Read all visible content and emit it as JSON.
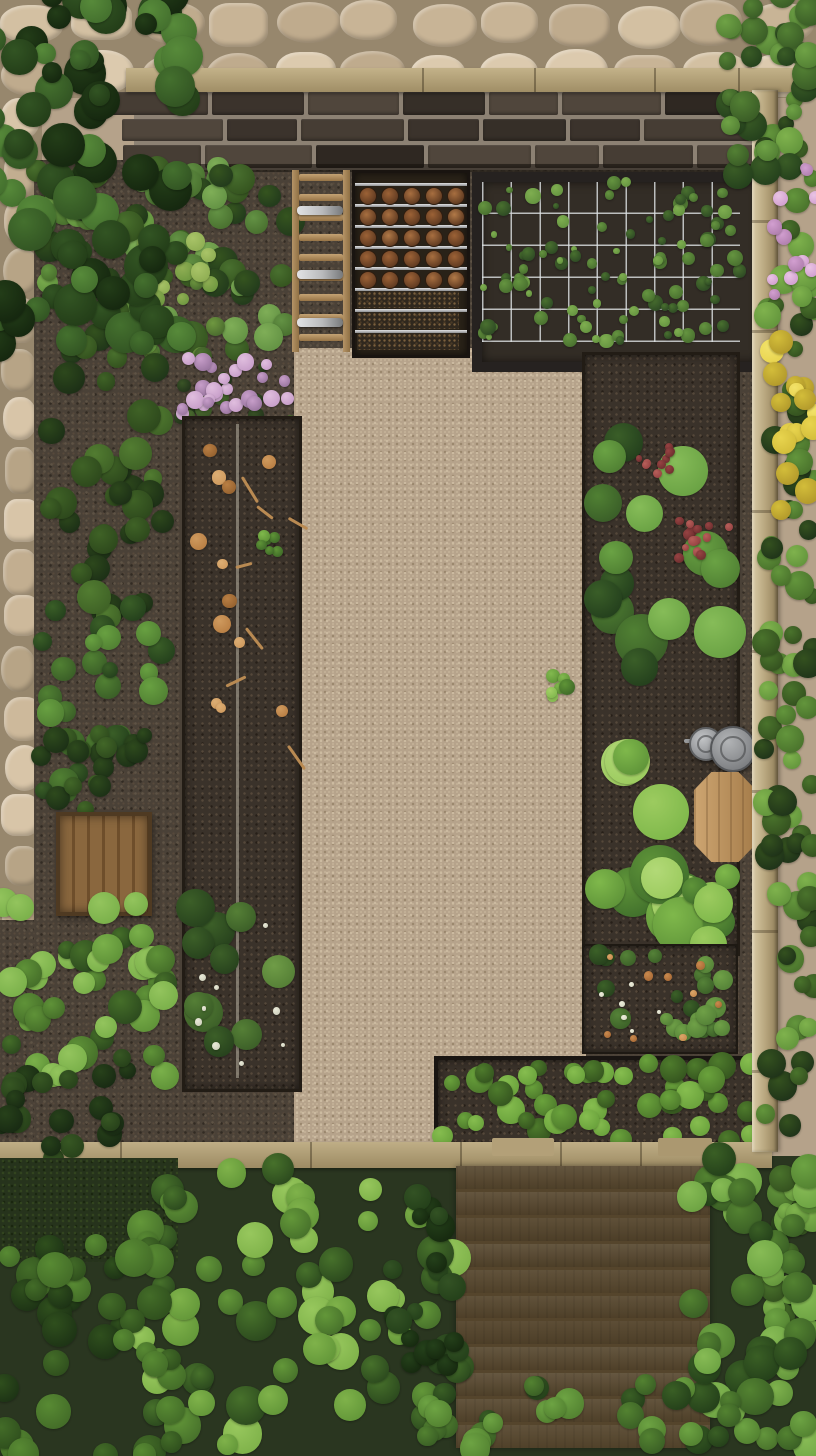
{
  "meta": {
    "title": "Aerial top-down view of a walled kitchen garden with raised beds, gravel path, stone paving, wooden deck and dense shrubs",
    "width": 816,
    "height": 1456
  },
  "palette": {
    "stone": "#d3c0a2",
    "grout": "#97876d",
    "brick": "#3b332c",
    "mortar": "#8c8173",
    "wood_rail": "#bfae86",
    "fence": "#c2b28c",
    "gravel": "#b6a38b",
    "soil": "#3a322a",
    "ground": "#4a4137",
    "leaf_dark": "#223a1c",
    "leaf_mid": "#49702f",
    "leaf_light": "#7fae57",
    "hedge": "#6aa23c",
    "pink": "#c79ec9",
    "yellow": "#e8d44e",
    "red": "#974343",
    "dry_leaf": "#b97f44",
    "deck": "#a78c63",
    "crate": "#7c5c38",
    "table": "#bf9a62",
    "bin": "#97999b",
    "wire": "#dee2e4",
    "white_flower": "#e9ead8",
    "orange_flower": "#c98a4e"
  },
  "items": [
    {
      "name": "stone-paving-top",
      "type": "cobbles",
      "x": 0,
      "y": 0,
      "w": 816,
      "h": 98,
      "cols": 12,
      "rows": 2,
      "jitter": 7,
      "seed": 3,
      "grout": "#97876d",
      "colors": [
        "#dccaae",
        "#d3c0a2",
        "#c8b496",
        "#bfab8d"
      ]
    },
    {
      "name": "stone-paving-left",
      "type": "cobbles",
      "x": 0,
      "y": 96,
      "w": 42,
      "h": 846,
      "cols": 1,
      "rows": 17,
      "jitter": 4,
      "seed": 4,
      "grout": "#97876d",
      "colors": [
        "#d8c5a8",
        "#cdb99b",
        "#c2ae90",
        "#b7a486"
      ]
    },
    {
      "name": "ground-left-under",
      "type": "rect",
      "x": 0,
      "y": 920,
      "w": 46,
      "h": 244,
      "texture": "ground"
    },
    {
      "name": "bottom-greenery-base",
      "type": "rect",
      "x": 0,
      "y": 1156,
      "w": 816,
      "h": 300,
      "fill": "#2a3620"
    },
    {
      "name": "garden-ground",
      "type": "rect",
      "x": 34,
      "y": 160,
      "w": 724,
      "h": 992,
      "texture": "ground"
    },
    {
      "name": "gravel-path",
      "type": "rect",
      "x": 294,
      "y": 348,
      "w": 292,
      "h": 800,
      "texture": "gravel"
    },
    {
      "name": "brick-wall",
      "type": "bricks",
      "x": 134,
      "y": 90,
      "w": 630,
      "h": 80,
      "rows": 3,
      "seed": 5,
      "mortar": "#8c8173",
      "colors": [
        "#3b332c",
        "#463d34",
        "#2f2822",
        "#50463c",
        "#362f28"
      ]
    },
    {
      "name": "top-wood-rail",
      "type": "wood",
      "x": 126,
      "y": 68,
      "w": 690,
      "h": 24,
      "dir": "h",
      "base": [
        "#c3b289",
        "#a08e66"
      ],
      "joints": [
        56,
        296,
        408,
        528,
        612
      ]
    },
    {
      "name": "beds-top-frame",
      "type": "rect",
      "x": 134,
      "y": 164,
      "w": 630,
      "h": 8,
      "fill": "rgba(25,20,15,0.6)"
    },
    {
      "name": "leafy-bed-foliage",
      "type": "blobs",
      "x": 138,
      "y": 166,
      "w": 156,
      "h": 186,
      "count": 42,
      "r": [
        8,
        17
      ],
      "seed": 11,
      "palette": [
        "#223a1c",
        "#35541f",
        "#49702f",
        "#639244",
        "#7fae57"
      ]
    },
    {
      "name": "leafy-bed-light-patch",
      "type": "blobs",
      "x": 128,
      "y": 238,
      "w": 92,
      "h": 118,
      "count": 22,
      "r": [
        6,
        12
      ],
      "seed": 12,
      "palette": [
        "#4a6b2e",
        "#6f9840",
        "#8fae53",
        "#a9c468"
      ]
    },
    {
      "name": "tool-rack",
      "type": "rack",
      "x": 292,
      "y": 170,
      "w": 58,
      "h": 182
    },
    {
      "name": "seedling-tray",
      "type": "tray",
      "x": 352,
      "y": 170,
      "w": 112,
      "h": 182
    },
    {
      "name": "trellis-bed",
      "type": "trellis",
      "x": 472,
      "y": 172,
      "w": 278,
      "h": 180,
      "cols": 9,
      "rows": 5,
      "seed": 14,
      "plants": 92,
      "palette": [
        "#2e4a24",
        "#49702f",
        "#659440",
        "#7fae50"
      ]
    },
    {
      "name": "flower-patch-greens",
      "type": "blobs",
      "x": 178,
      "y": 350,
      "w": 118,
      "h": 74,
      "count": 16,
      "r": [
        5,
        10
      ],
      "seed": 15,
      "palette": [
        "#22331b",
        "#3a5426",
        "#4e7031"
      ]
    },
    {
      "name": "pink-flower-cluster",
      "type": "blobs",
      "x": 180,
      "y": 350,
      "w": 112,
      "h": 68,
      "count": 26,
      "r": [
        5,
        9
      ],
      "seed": 16,
      "palette": [
        "#9a76a0",
        "#c79ec9",
        "#e0bede"
      ]
    },
    {
      "name": "long-raised-bed",
      "type": "bed",
      "x": 182,
      "y": 416,
      "w": 114,
      "h": 670,
      "border": "#221c15",
      "bw": 3,
      "texture": "soil"
    },
    {
      "name": "irrigation-line",
      "type": "rect",
      "x": 236,
      "y": 424,
      "w": 3,
      "h": 654,
      "fill": "rgba(150,143,130,0.75)"
    },
    {
      "name": "dry-leaves",
      "type": "blobs",
      "x": 192,
      "y": 428,
      "w": 94,
      "h": 300,
      "count": 12,
      "r": [
        5,
        9
      ],
      "seed": 19,
      "palette": [
        "#96622f",
        "#b97f44",
        "#cf9a5e",
        "#dcae74"
      ]
    },
    {
      "name": "dry-twigs",
      "type": "twigs",
      "x": 210,
      "y": 440,
      "w": 80,
      "h": 330,
      "count": 7,
      "seed": 20,
      "color": "#b98a52",
      "len": [
        16,
        30
      ],
      "thick": 3
    },
    {
      "name": "bed-sprout",
      "type": "blobs",
      "x": 256,
      "y": 534,
      "w": 24,
      "h": 20,
      "count": 6,
      "r": [
        4,
        7
      ],
      "seed": 21,
      "palette": [
        "#3f6a28",
        "#5f9437",
        "#7fb84b"
      ]
    },
    {
      "name": "rosette-plants",
      "type": "blobs",
      "x": 194,
      "y": 888,
      "w": 94,
      "h": 188,
      "count": 10,
      "r": [
        14,
        21
      ],
      "seed": 22,
      "palette": [
        "#27421d",
        "#3c5f28",
        "#557f36",
        "#6f9c47"
      ]
    },
    {
      "name": "rosette-flowers-white",
      "type": "blobs",
      "x": 198,
      "y": 898,
      "w": 86,
      "h": 175,
      "count": 9,
      "r": [
        2,
        4
      ],
      "seed": 23,
      "palette": [
        "#cfd0bd",
        "#e9ead8"
      ]
    },
    {
      "name": "right-main-bed",
      "type": "bed",
      "x": 582,
      "y": 352,
      "w": 152,
      "h": 598,
      "border": "#221c15",
      "bw": 3,
      "texture": "soil"
    },
    {
      "name": "lettuce-upper",
      "type": "blobs",
      "x": 588,
      "y": 358,
      "w": 142,
      "h": 340,
      "count": 15,
      "r": [
        16,
        27
      ],
      "seed": 25,
      "palette": [
        "#24401d",
        "#3a5e28",
        "#508033",
        "#6aa244",
        "#86bc58"
      ]
    },
    {
      "name": "red-flower-cluster-a",
      "type": "blobs",
      "x": 636,
      "y": 444,
      "w": 40,
      "h": 30,
      "count": 10,
      "r": [
        3,
        5
      ],
      "seed": 26,
      "palette": [
        "#6f2f2f",
        "#974343",
        "#b75f5a"
      ]
    },
    {
      "name": "red-flower-cluster-b",
      "type": "blobs",
      "x": 678,
      "y": 520,
      "w": 56,
      "h": 44,
      "count": 14,
      "r": [
        3,
        6
      ],
      "seed": 27,
      "palette": [
        "#6f2f2f",
        "#974343",
        "#b75f5a"
      ]
    },
    {
      "name": "bin-handle",
      "type": "rect",
      "x": 684,
      "y": 739,
      "w": 16,
      "h": 4,
      "fill": "#9a9c9e",
      "radius": 2
    },
    {
      "name": "compost-bin-small",
      "type": "circle",
      "cx": 704,
      "cy": 742,
      "r": 15,
      "fill1": "#c2c4c6",
      "fill2": "#85878a",
      "ring": "#5e6062"
    },
    {
      "name": "compost-bin-large",
      "type": "circle",
      "cx": 731,
      "cy": 747,
      "r": 21,
      "fill1": "#b2b4b6",
      "fill2": "#7b7d80",
      "ring": "#55575a"
    },
    {
      "name": "wooden-table",
      "type": "table",
      "x": 694,
      "y": 772,
      "w": 62,
      "h": 90,
      "c1": "#cda571",
      "c2": "#a57c4a"
    },
    {
      "name": "lettuce-lower-light",
      "type": "blobs",
      "x": 584,
      "y": 748,
      "w": 116,
      "h": 200,
      "count": 12,
      "r": [
        18,
        30
      ],
      "seed": 31,
      "palette": [
        "#41702c",
        "#5f9439",
        "#7fb84b",
        "#9ccb5f",
        "#b2d977"
      ]
    },
    {
      "name": "lettuce-below-table",
      "type": "blobs",
      "x": 688,
      "y": 862,
      "w": 48,
      "h": 84,
      "count": 6,
      "r": [
        12,
        20
      ],
      "seed": 58,
      "palette": [
        "#41702c",
        "#5f9439",
        "#7fb84b",
        "#9ccb5f"
      ]
    },
    {
      "name": "berry-sub-bed",
      "type": "bed",
      "x": 582,
      "y": 944,
      "w": 152,
      "h": 106,
      "border": "#1e1913",
      "bw": 2,
      "texture": "soil"
    },
    {
      "name": "berry-plants",
      "type": "blobs",
      "x": 588,
      "y": 950,
      "w": 140,
      "h": 94,
      "count": 22,
      "r": [
        6,
        11
      ],
      "seed": 33,
      "palette": [
        "#27421d",
        "#3c6128",
        "#558238",
        "#6fa047"
      ]
    },
    {
      "name": "berry-flowers-orange",
      "type": "blobs",
      "x": 592,
      "y": 956,
      "w": 132,
      "h": 84,
      "count": 9,
      "r": [
        3,
        5
      ],
      "seed": 34,
      "palette": [
        "#a96a36",
        "#c98a4e",
        "#dba669"
      ]
    },
    {
      "name": "berry-flowers-white",
      "type": "blobs",
      "x": 596,
      "y": 954,
      "w": 124,
      "h": 80,
      "count": 6,
      "r": [
        2,
        3
      ],
      "seed": 35,
      "palette": [
        "#d8d9c6",
        "#ecedda"
      ]
    },
    {
      "name": "gravel-sprout",
      "type": "blobs",
      "x": 548,
      "y": 672,
      "w": 26,
      "h": 30,
      "count": 6,
      "r": [
        4,
        8
      ],
      "seed": 57,
      "palette": [
        "#3f6a28",
        "#5f9437",
        "#82b94e",
        "#a4cf66"
      ]
    },
    {
      "name": "hedge-planter",
      "type": "bed",
      "x": 434,
      "y": 1056,
      "w": 322,
      "h": 90,
      "border": "#191512",
      "bw": 4,
      "texture": "soil"
    },
    {
      "name": "hedge-foliage",
      "type": "blobs",
      "x": 440,
      "y": 1062,
      "w": 312,
      "h": 80,
      "count": 46,
      "r": [
        8,
        14
      ],
      "seed": 37,
      "palette": [
        "#35551f",
        "#4e7b2c",
        "#6aa23c",
        "#86bd4f"
      ]
    },
    {
      "name": "bottom-wood-border",
      "type": "wood",
      "x": 0,
      "y": 1142,
      "w": 772,
      "h": 26,
      "dir": "h",
      "base": [
        "#bfae86",
        "#9d8b63"
      ],
      "joints": [
        120,
        310,
        460,
        560,
        640,
        714
      ]
    },
    {
      "name": "border-plank-a",
      "type": "rect",
      "x": 492,
      "y": 1138,
      "w": 62,
      "h": 18,
      "fill": "#b3a078",
      "radius": 2
    },
    {
      "name": "border-plank-b",
      "type": "rect",
      "x": 658,
      "y": 1138,
      "w": 54,
      "h": 18,
      "fill": "#ab9870",
      "radius": 2
    },
    {
      "name": "garden-deck",
      "type": "deck",
      "x": 456,
      "y": 1166,
      "w": 254,
      "h": 282,
      "planks": 11,
      "seed": 39
    },
    {
      "name": "right-fence-rail",
      "type": "fence",
      "x": 752,
      "y": 90,
      "w": 26,
      "h": 1062,
      "joints": [
        130,
        240,
        420,
        560,
        700,
        840,
        980
      ]
    },
    {
      "name": "right-border-bushes",
      "type": "blobs",
      "x": 764,
      "y": 96,
      "w": 52,
      "h": 1360,
      "count": 120,
      "r": [
        8,
        15
      ],
      "seed": 41,
      "palette": [
        "#1f3319",
        "#34511f",
        "#4a732c",
        "#63953c",
        "#7fb24d"
      ]
    },
    {
      "name": "top-right-corner-bush",
      "type": "blobs",
      "x": 726,
      "y": -6,
      "w": 92,
      "h": 186,
      "count": 34,
      "r": [
        8,
        16
      ],
      "seed": 42,
      "palette": [
        "#24401c",
        "#3a5c26",
        "#538034",
        "#6fa246"
      ]
    },
    {
      "name": "pink-roses-right",
      "type": "blobs",
      "x": 772,
      "y": 162,
      "w": 44,
      "h": 142,
      "count": 12,
      "r": [
        5,
        8
      ],
      "seed": 43,
      "palette": [
        "#b07fae",
        "#d29fd0",
        "#e9c4e4"
      ]
    },
    {
      "name": "yellow-flowers-right",
      "type": "blobs",
      "x": 764,
      "y": 336,
      "w": 52,
      "h": 186,
      "count": 16,
      "r": [
        7,
        13
      ],
      "seed": 44,
      "palette": [
        "#b2992b",
        "#d3bd3a",
        "#e8d44e",
        "#f2e26a"
      ]
    },
    {
      "name": "left-bushes-top",
      "type": "blobs",
      "x": 34,
      "y": 168,
      "w": 132,
      "h": 210,
      "count": 30,
      "r": [
        8,
        16
      ],
      "seed": 45,
      "palette": [
        "#1f3519",
        "#33511e",
        "#49702d",
        "#61923e",
        "#7cae4f"
      ]
    },
    {
      "name": "left-bushes-mid",
      "type": "blobs",
      "x": 34,
      "y": 368,
      "w": 130,
      "h": 250,
      "count": 32,
      "r": [
        9,
        17
      ],
      "seed": 46,
      "palette": [
        "#1c2f16",
        "#2d481c",
        "#3f6226",
        "#527c31"
      ]
    },
    {
      "name": "left-bushes-low",
      "type": "blobs",
      "x": 38,
      "y": 608,
      "w": 124,
      "h": 190,
      "count": 26,
      "r": [
        8,
        15
      ],
      "seed": 47,
      "palette": [
        "#24401c",
        "#3a5e27",
        "#518033",
        "#68a041"
      ]
    },
    {
      "name": "left-bush-above-crate",
      "type": "blobs",
      "x": 40,
      "y": 732,
      "w": 116,
      "h": 86,
      "count": 18,
      "r": [
        7,
        13
      ],
      "seed": 48,
      "palette": [
        "#1c3016",
        "#2e4a1d",
        "#426728"
      ]
    },
    {
      "name": "wooden-crate",
      "type": "crate",
      "x": 56,
      "y": 812,
      "w": 88,
      "h": 96
    },
    {
      "name": "left-bush-bright",
      "type": "blobs",
      "x": 0,
      "y": 900,
      "w": 168,
      "h": 178,
      "count": 40,
      "r": [
        9,
        17
      ],
      "seed": 49,
      "palette": [
        "#2c4a1e",
        "#456e29",
        "#5f9238",
        "#7ab04a",
        "#93c45d"
      ]
    },
    {
      "name": "left-bush-dark-low",
      "type": "blobs",
      "x": 0,
      "y": 1052,
      "w": 130,
      "h": 110,
      "count": 22,
      "r": [
        8,
        14
      ],
      "seed": 50,
      "palette": [
        "#182a13",
        "#27411a",
        "#375723"
      ]
    },
    {
      "name": "moss-ground",
      "type": "rect",
      "x": 0,
      "y": 1158,
      "w": 178,
      "h": 104,
      "texture": "moss"
    },
    {
      "name": "fern-shrubs",
      "type": "blobs",
      "x": 140,
      "y": 1168,
      "w": 324,
      "h": 286,
      "count": 64,
      "r": [
        10,
        20
      ],
      "seed": 51,
      "palette": [
        "#2c4a1e",
        "#47712b",
        "#639739",
        "#7fb24a",
        "#97c75d"
      ]
    },
    {
      "name": "conifer-dark",
      "type": "blobs",
      "x": 392,
      "y": 1196,
      "w": 74,
      "h": 170,
      "count": 22,
      "r": [
        8,
        15
      ],
      "seed": 52,
      "palette": [
        "#16290f",
        "#24401a",
        "#335224"
      ]
    },
    {
      "name": "bottom-left-shrubs",
      "type": "blobs",
      "x": 0,
      "y": 1228,
      "w": 180,
      "h": 228,
      "count": 42,
      "r": [
        10,
        19
      ],
      "seed": 53,
      "palette": [
        "#1d3315",
        "#2f4f1d",
        "#436c28",
        "#588a33"
      ]
    },
    {
      "name": "bottom-right-shrubs",
      "type": "blobs",
      "x": 688,
      "y": 1150,
      "w": 128,
      "h": 306,
      "count": 44,
      "r": [
        10,
        19
      ],
      "seed": 54,
      "palette": [
        "#24401a",
        "#3a5f25",
        "#538231",
        "#6da343",
        "#87bb55"
      ]
    },
    {
      "name": "deck-bottom-shrubs",
      "type": "blobs",
      "x": 420,
      "y": 1382,
      "w": 310,
      "h": 74,
      "count": 26,
      "r": [
        9,
        16
      ],
      "seed": 55,
      "palette": [
        "#24401a",
        "#3a5f25",
        "#538231",
        "#6da343"
      ]
    },
    {
      "name": "overhanging-tree",
      "type": "blobs",
      "x": -10,
      "y": -10,
      "w": 195,
      "h": 360,
      "count": 80,
      "r": [
        10,
        22
      ],
      "seed": 56,
      "palette": [
        "#15270f",
        "#233d18",
        "#325423",
        "#44702e",
        "#578a3a"
      ]
    }
  ]
}
